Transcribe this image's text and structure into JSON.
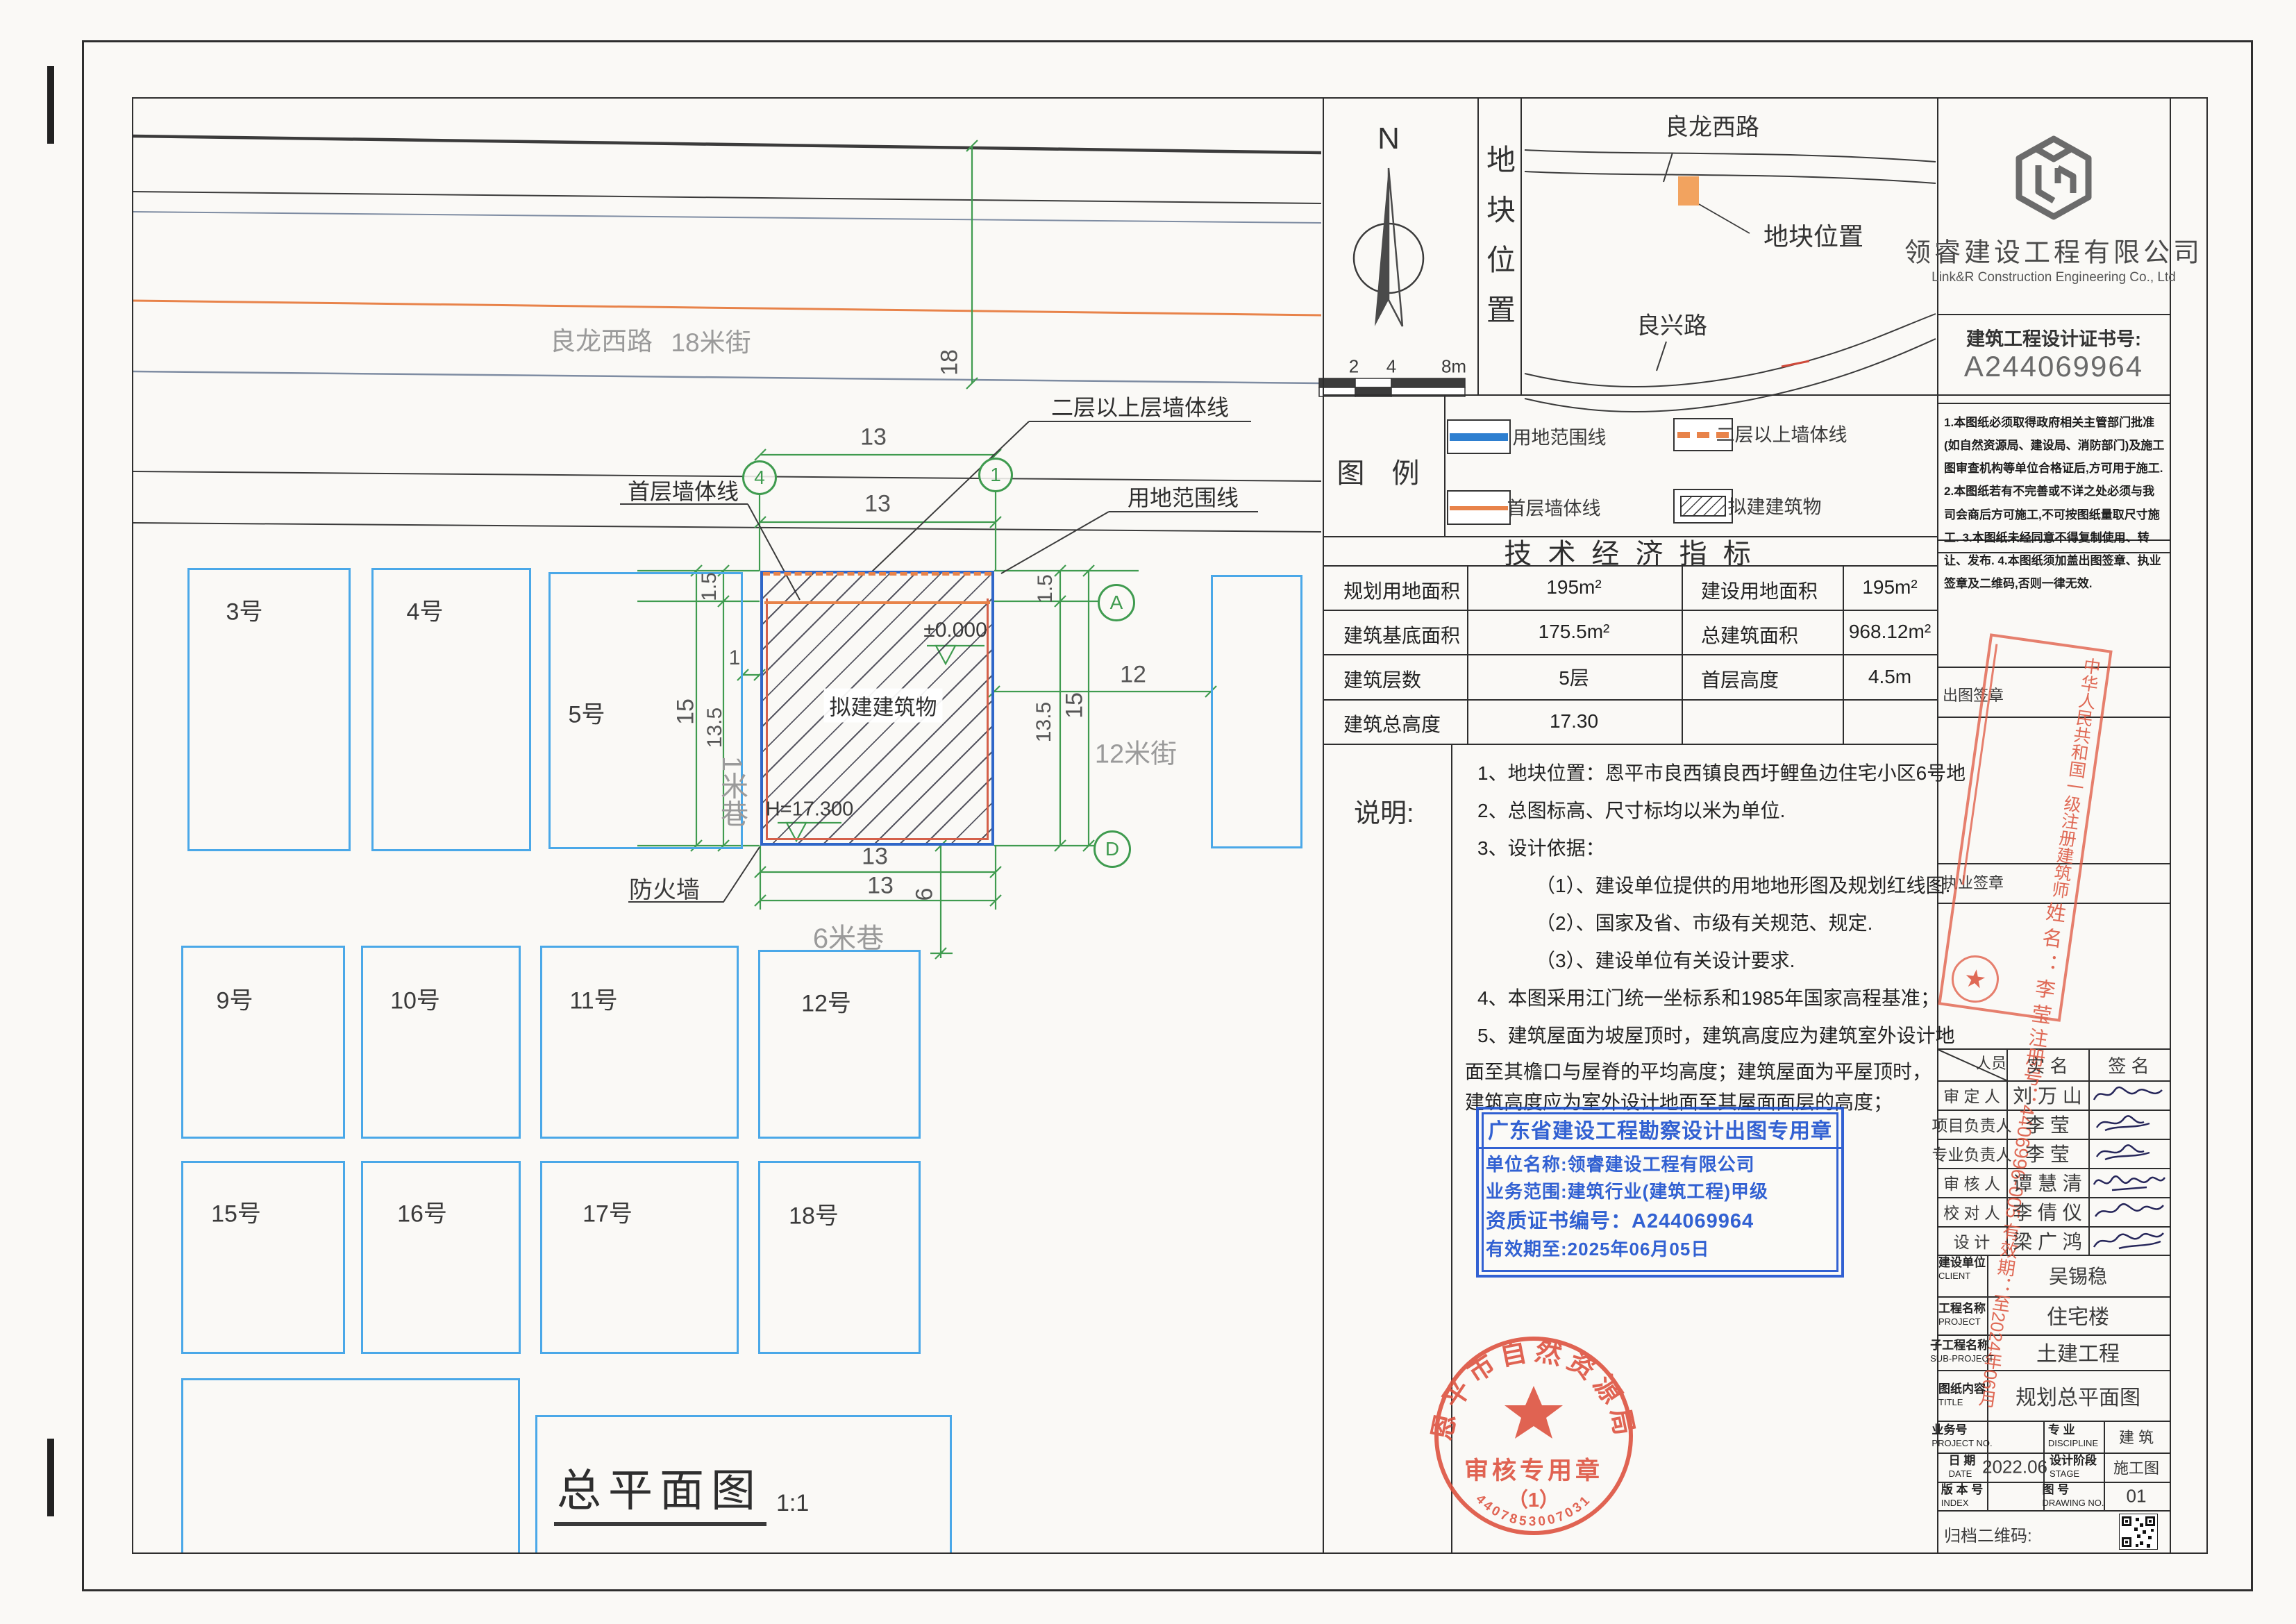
{
  "plan": {
    "title": {
      "text": "总平面图",
      "scale": "1:1"
    },
    "streets": {
      "main_road": "良龙西路",
      "main_road_width": "18米街",
      "lane_1m": "1米巷",
      "street_12m": "12米街",
      "lane_6m": "6米巷"
    },
    "plots": [
      "3号",
      "4号",
      "5号",
      "9号",
      "10号",
      "11号",
      "12号",
      "15号",
      "16号",
      "17号",
      "18号"
    ],
    "building_label": "拟建建筑物",
    "levels": {
      "zero": "±0.000",
      "height": "H=17.300"
    },
    "firewall": "防火墙",
    "leaders": {
      "upper_wall": "二层以上层墙体线",
      "first_floor_wall": "首层墙体线",
      "boundary": "用地范围线"
    },
    "grid": {
      "c4": "4",
      "c1": "1",
      "rA": "A",
      "rD": "D"
    },
    "dims": {
      "street18": "18",
      "top_a": "13",
      "top_b": "13",
      "left_edge": "1.5",
      "left_total": "15",
      "left_inner": "13.5",
      "lane_gap": "1",
      "right_edge": "1.5",
      "right_inner": "13.5",
      "right_total": "15",
      "street_gap": "12",
      "bottom_a": "13",
      "bottom_b": "13",
      "alley": "6"
    }
  },
  "title_block": {
    "north": {
      "label": "N",
      "ticks": [
        "2",
        "4",
        "8m"
      ]
    },
    "location": {
      "side_label": "地块位置",
      "road_top": "良龙西路",
      "road_bottom": "良兴路",
      "marker_label": "地块位置"
    },
    "company": {
      "name": "领睿建设工程有限公司",
      "name_en": "Link&R Construction Engineering Co., Ltd",
      "cert_label": "建筑工程设计证书号:",
      "cert_no": "A244069964"
    },
    "right_notes": [
      "1.本图纸必须取得政府相关主管部门批准(如自然资源局、建设局、消防部门)及施工图审查机构等单位合格证后,方可用于施工.",
      "2.本图纸若有不完善或不详之处必须与我司会商后方可施工,不可按图纸量取尺寸施工.",
      "3.本图纸未经同意不得复制使用、转让、发布.",
      "4.本图纸须加盖出图签章、执业签章及二维码,否则一律无效."
    ],
    "legend": {
      "title": "图 例",
      "items": [
        "用地范围线",
        "二层以上墙体线",
        "首层墙体线",
        "拟建建筑物"
      ]
    },
    "indicators": {
      "title": "技 术 经 济 指 标",
      "rows": [
        [
          "规划用地面积",
          "195m²",
          "建设用地面积",
          "195m²"
        ],
        [
          "建筑基底面积",
          "175.5m²",
          "总建筑面积",
          "968.12m²"
        ],
        [
          "建筑层数",
          "5层",
          "首层高度",
          "4.5m"
        ],
        [
          "建筑总高度",
          "17.30",
          "",
          ""
        ]
      ]
    },
    "shuoming": {
      "label": "说明:",
      "lines": [
        "1、地块位置：恩平市良西镇良西圩鲤鱼边住宅小区6号地",
        "2、总图标高、尺寸标均以米为单位.",
        "3、设计依据：",
        "（1）、建设单位提供的用地地形图及规划红线图.",
        "（2）、国家及省、市级有关规范、规定.",
        "（3）、建设单位有关设计要求.",
        "4、本图采用江门统一坐标系和1985年国家高程基准；",
        "5、建筑屋面为坡屋顶时，建筑高度应为建筑室外设计地",
        "面至其檐口与屋脊的平均高度；建筑屋面为平屋顶时，",
        "建筑高度应为室外设计地面至其屋面面层的高度；"
      ]
    },
    "stamp_labels": {
      "chutu": "出图签章",
      "zhiye": "执业签章"
    },
    "reg_stamp": {
      "title": "中华人民共和国一级注册建筑师",
      "name": "姓 名 ： 李  莹",
      "reg_no": "注册号：4406996-005",
      "valid": "有效期：至2024年06月"
    },
    "blue_stamp": {
      "l1": "广东省建设工程勘察设计出图专用章",
      "l2": "单位名称:领睿建设工程有限公司",
      "l3": "业务范围:建筑行业(建筑工程)甲级",
      "l4": "资质证书编号：A244069964",
      "l5": "有效期至:2025年06月05日"
    },
    "round_stamp": {
      "arc": "恩平市自然资源局",
      "line1": "审核专用章",
      "line2": "（1）",
      "serial": "4407853007031"
    },
    "personnel": {
      "header": {
        "who": "人员",
        "name": "实  名",
        "sign": "签  名"
      },
      "rows": [
        {
          "role": "审 定 人",
          "name": "刘 万 山"
        },
        {
          "role": "项目负责人",
          "name": "李  莹"
        },
        {
          "role": "专业负责人",
          "name": "李  莹"
        },
        {
          "role": "审 核 人",
          "name": "谭 慧 清"
        },
        {
          "role": "校 对 人",
          "name": "李 倩 仪"
        },
        {
          "role": "设  计",
          "name": "梁 广 鸿"
        }
      ]
    },
    "info": {
      "r1": {
        "zh": "建设单位",
        "en": "CLIENT",
        "v": "吴锡稳"
      },
      "r2": {
        "zh": "工程名称",
        "en": "PROJECT",
        "v": "住宅楼"
      },
      "r3": {
        "zh": "子工程名称",
        "en": "SUB-PROJECT",
        "v": "土建工程"
      },
      "r4": {
        "zh": "图纸内容",
        "en": "TITLE",
        "v": "规划总平面图"
      },
      "r5": {
        "zh": "业务号",
        "en": "PROJECT NO.",
        "v": "",
        "zh2": "专 业",
        "en2": "DISCIPLINE",
        "v2": "建 筑"
      },
      "r6": {
        "zh": "日 期",
        "en": "DATE",
        "v": "2022.06",
        "zh2": "设计阶段",
        "en2": "STAGE",
        "v2": "施工图"
      },
      "r7": {
        "zh": "版 本 号",
        "en": "INDEX",
        "v": "",
        "zh2": "图 号",
        "en2": "DRAWING NO.",
        "v2": "01"
      },
      "qr_label": "归档二维码:"
    }
  }
}
